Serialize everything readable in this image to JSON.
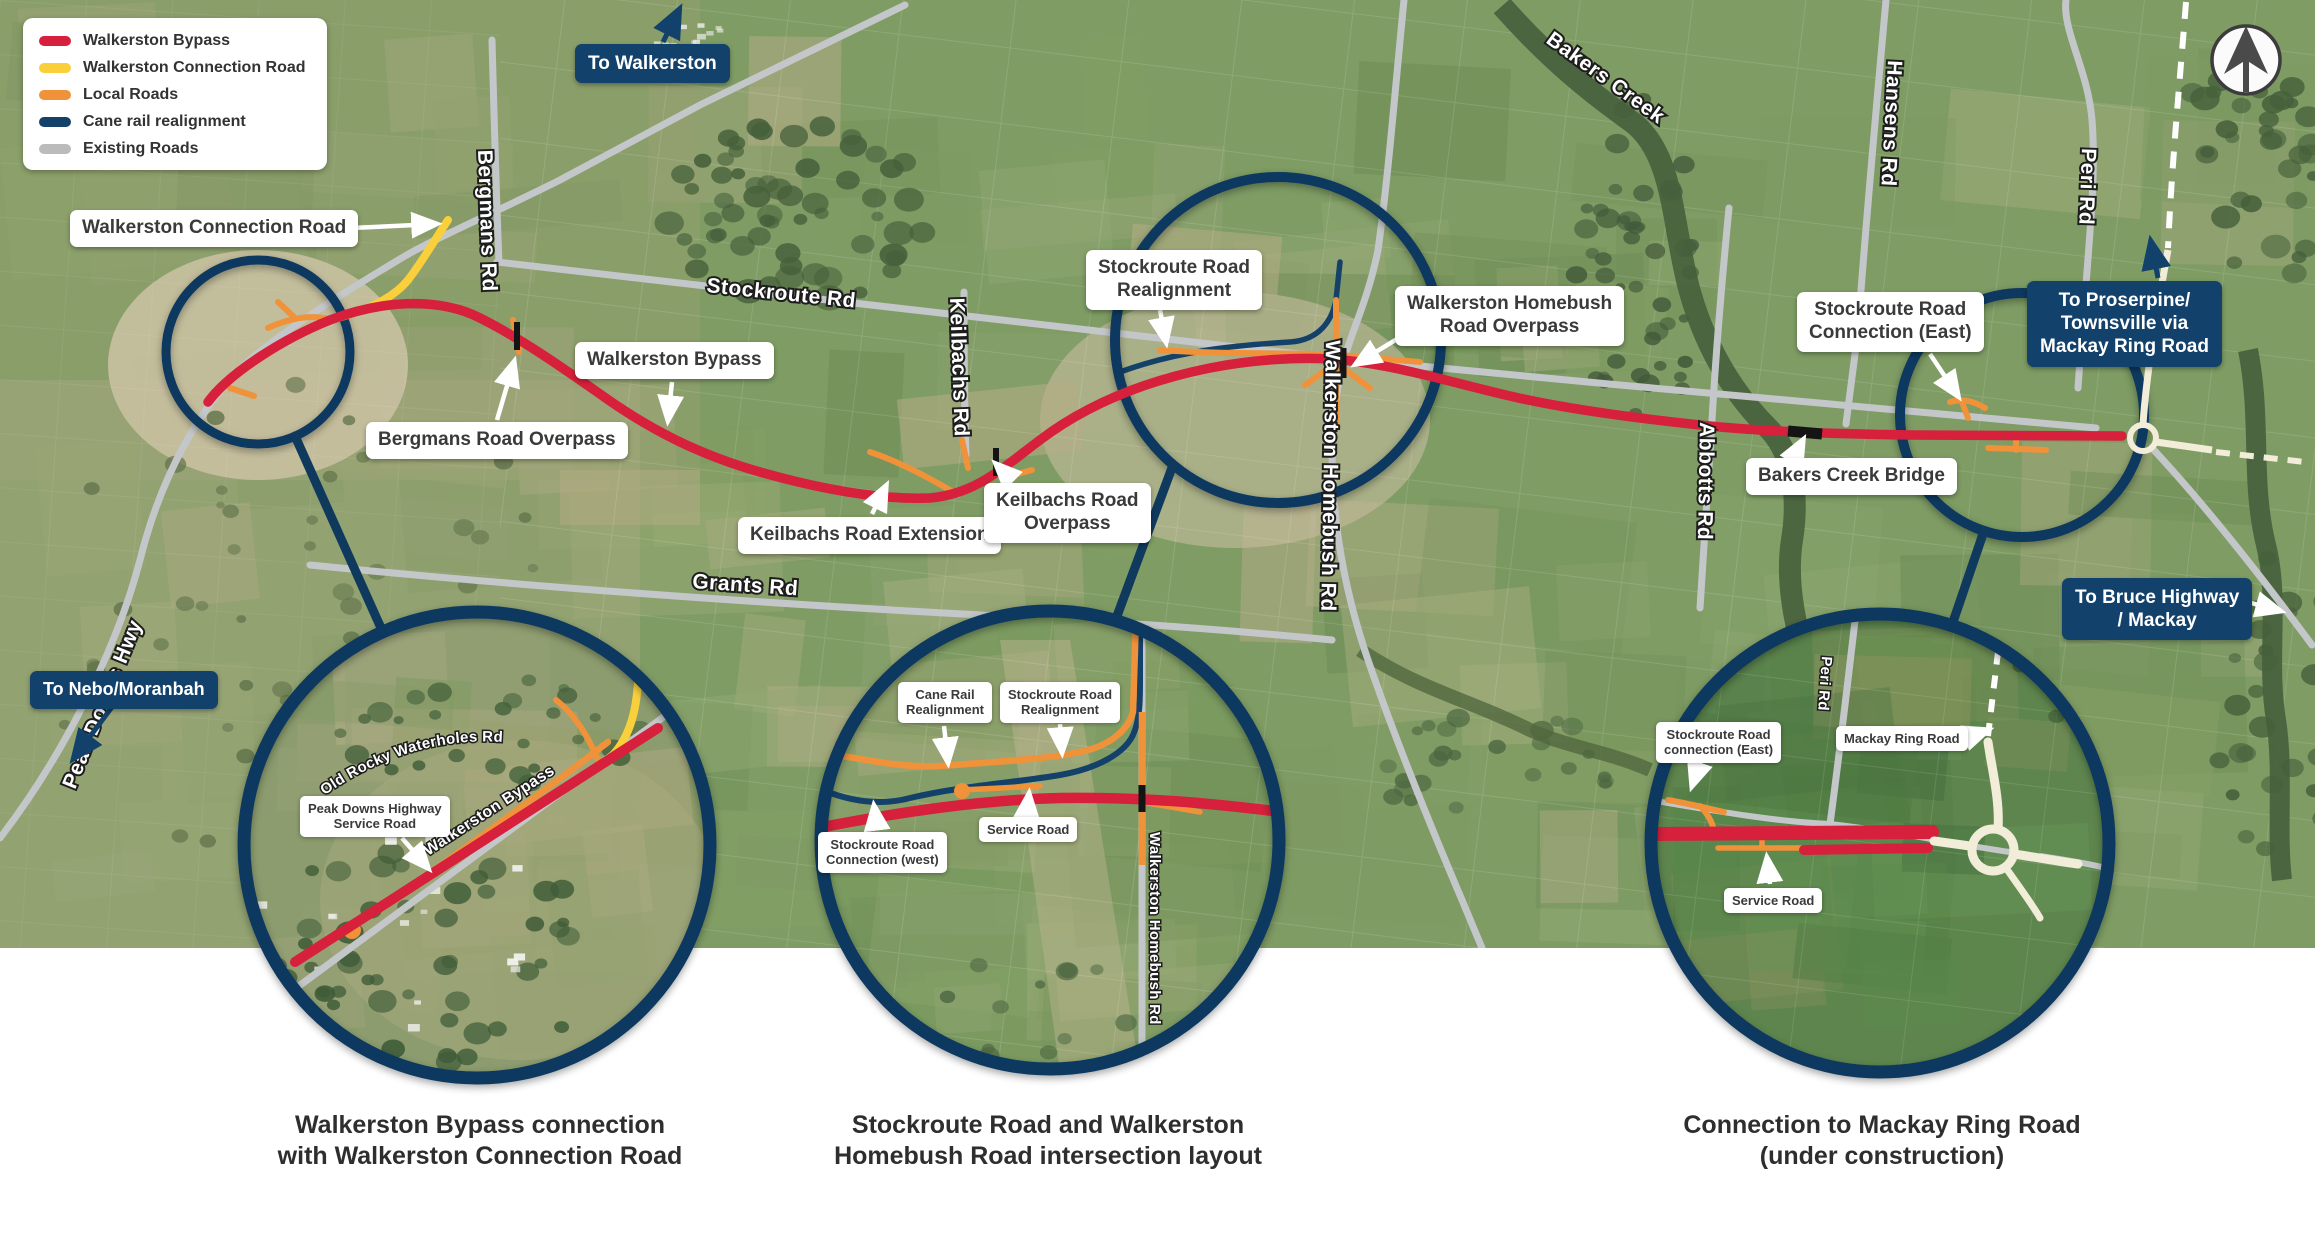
{
  "legend": {
    "items": [
      {
        "label": "Walkerston Bypass",
        "color": "#d6203c"
      },
      {
        "label": "Walkerston Connection Road",
        "color": "#f9cf3b"
      },
      {
        "label": "Local Roads",
        "color": "#f0923a"
      },
      {
        "label": "Cane rail realignment",
        "color": "#14416a"
      },
      {
        "label": "Existing Roads",
        "color": "#bbbbbb"
      }
    ]
  },
  "directions": {
    "to_walkerston": "To Walkerston",
    "to_nebo": "To Nebo/Moranbah",
    "to_proserpine": {
      "line1": "To Proserpine/",
      "line2": "Townsville via",
      "line3": "Mackay Ring Road"
    },
    "to_bruce": {
      "line1": "To Bruce Highway",
      "line2": "/ Mackay"
    }
  },
  "callouts": {
    "walkerston_connection_road": "Walkerston Connection Road",
    "walkerston_bypass": "Walkerston Bypass",
    "bergmans_road_overpass": "Bergmans Road Overpass",
    "keilbachs_road_extension": "Keilbachs Road Extension",
    "keilbachs_road_overpass": {
      "line1": "Keilbachs Road",
      "line2": "Overpass"
    },
    "stockroute_road_realignment": {
      "line1": "Stockroute Road",
      "line2": "Realignment"
    },
    "walkerston_homebush_road_overpass": {
      "line1": "Walkerston Homebush",
      "line2": "Road Overpass"
    },
    "stockroute_road_connection_east": {
      "line1": "Stockroute Road",
      "line2": "Connection (East)"
    },
    "bakers_creek_bridge": "Bakers Creek Bridge"
  },
  "roads": {
    "peak_downs_hwy": "Peak Downs Hwy",
    "bergmans_rd": "Bergmans Rd",
    "stockroute_rd": "Stockroute Rd",
    "keilbachs_rd": "Keilbachs Rd",
    "grants_rd": "Grants Rd",
    "walkerston_homebush_rd": "Walkerston Homebush Rd",
    "abbotts_rd": "Abbotts Rd",
    "hansens_rd": "Hansens Rd",
    "peri_rd": "Peri Rd",
    "bakers_creek": "Bakers Creek"
  },
  "insets": {
    "inset1": {
      "caption": {
        "line1": "Walkerston Bypass connection",
        "line2": "with Walkerston Connection Road"
      },
      "old_rocky_waterholes_rd": "Old Rocky Waterholes Rd",
      "peak_downs_service_road": {
        "line1": "Peak Downs Highway",
        "line2": "Service Road"
      },
      "walkerston_bypass": "Walkerston Bypass"
    },
    "inset2": {
      "caption": {
        "line1": "Stockroute Road and Walkerston",
        "line2": "Homebush Road intersection layout"
      },
      "cane_rail_realignment": {
        "line1": "Cane Rail",
        "line2": "Realignment"
      },
      "stockroute_road_realignment": {
        "line1": "Stockroute Road",
        "line2": "Realignment"
      },
      "service_road": "Service Road",
      "stockroute_road_connection_west": {
        "line1": "Stockroute Road",
        "line2": "Connection (west)"
      },
      "walkerston_homebush_rd": "Walkerston Homebush Rd"
    },
    "inset3": {
      "caption": {
        "line1": "Connection to Mackay Ring Road",
        "line2": "(under construction)"
      },
      "stockroute_road_connection_east": {
        "line1": "Stockroute Road",
        "line2": "connection (East)"
      },
      "mackay_ring_road": "Mackay Ring Road",
      "service_road": "Service Road",
      "peri_rd": "Peri Rd"
    }
  },
  "colors": {
    "bypass": "#d6203c",
    "connection_road": "#f9cf3b",
    "local_roads": "#f0923a",
    "cane_rail": "#14416a",
    "existing_roads": "#c4c7c9",
    "highlight_circle": "#10395e",
    "label_navy": "#12416b",
    "ring_road_cream": "#f1edd8"
  }
}
